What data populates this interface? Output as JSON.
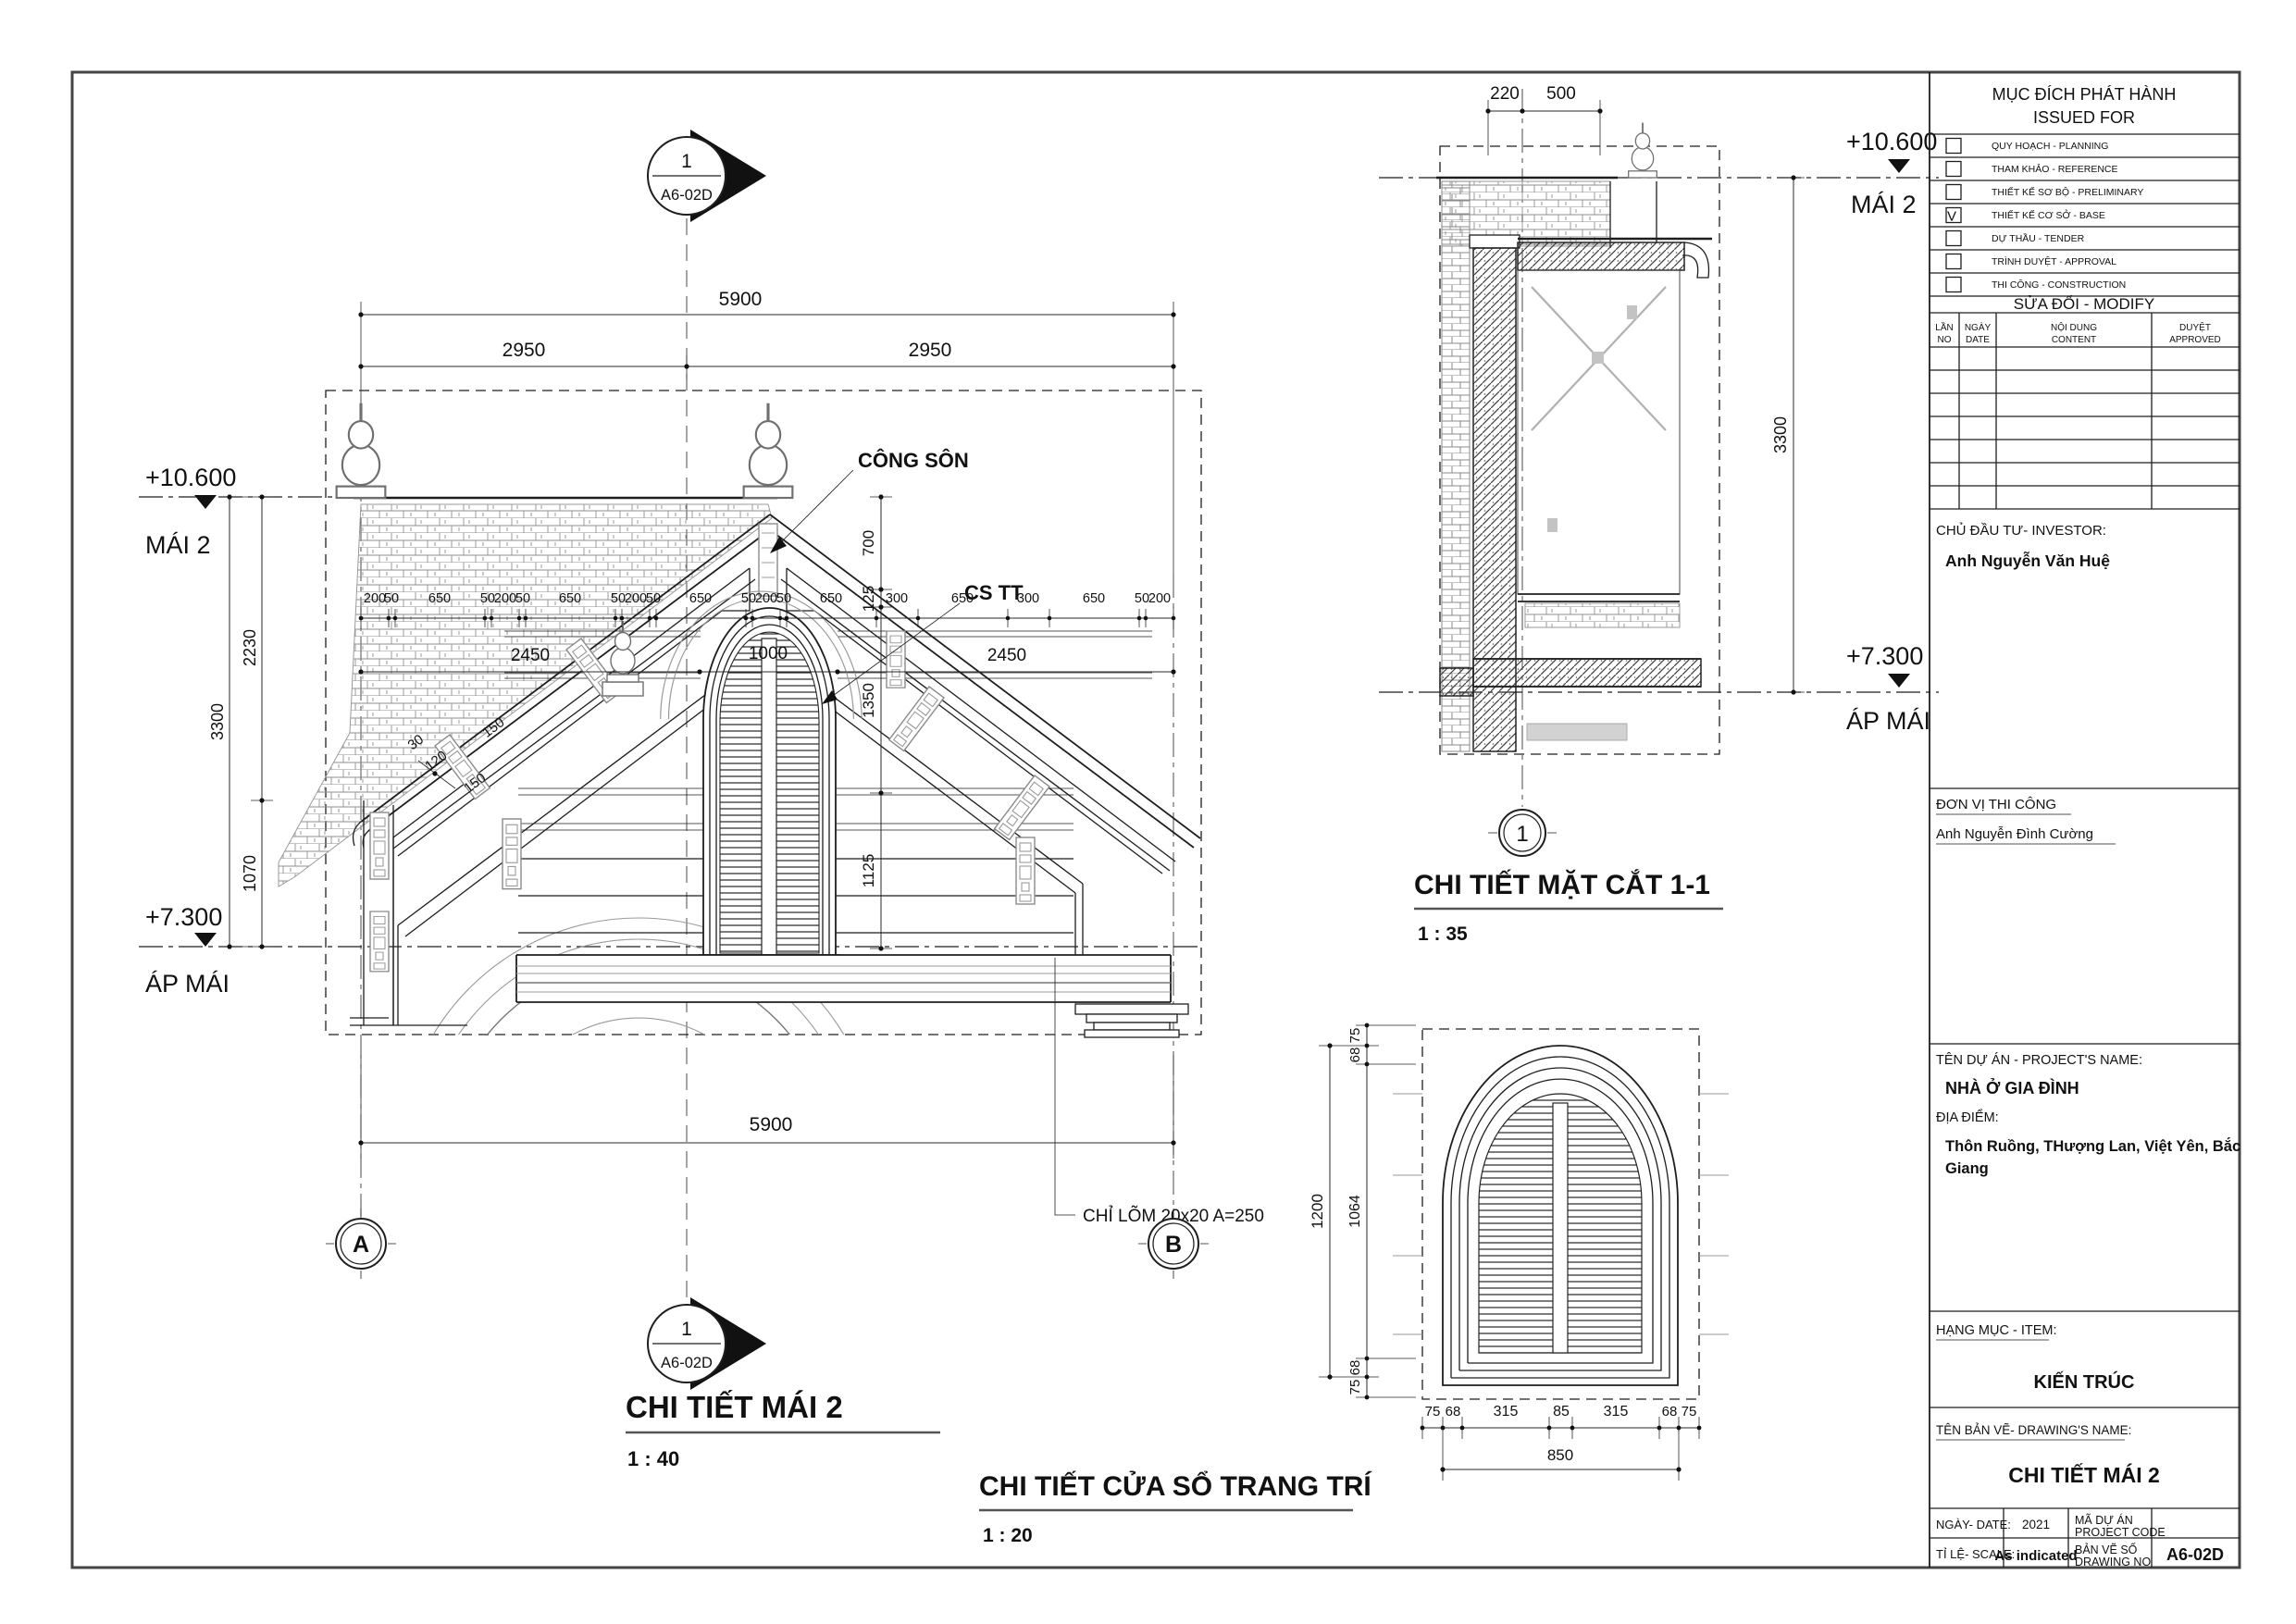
{
  "sheet": {
    "bg": "#ffffff",
    "line_color": "#1e1e1e",
    "gray_color": "#9a9a9a",
    "border_color": "#454545"
  },
  "levels": {
    "mai2": {
      "elev": "+10.600",
      "name": "MÁI 2"
    },
    "ap_mai": {
      "elev": "+7.300",
      "name": "ÁP MÁI"
    }
  },
  "callout": {
    "number": "1",
    "sheet": "A6-02D"
  },
  "views": {
    "roof": {
      "title": "CHI TIẾT MÁI 2",
      "scale": "1 : 40",
      "grids": [
        "A",
        "B"
      ],
      "annotations": {
        "cong_son": "CÔNG SÔN",
        "cs_tt": "CS TT",
        "chi_lom": "CHỈ LÕM 20x20 A=250"
      },
      "dims": {
        "top_total": "5900",
        "halves": [
          "2950",
          "2950"
        ],
        "chain": [
          "200",
          "50",
          "650",
          "50",
          "200",
          "50",
          "650",
          "50",
          "200",
          "50",
          "650",
          "50",
          "200",
          "50",
          "650",
          "300",
          "650",
          "300",
          "650",
          "50",
          "200"
        ],
        "mid": [
          "2450",
          "1000",
          "2450"
        ],
        "right_col": [
          "700",
          "125",
          "1350",
          "1125"
        ],
        "left_total": "3300",
        "left_segs": [
          "2230",
          "1070"
        ],
        "slope": [
          "150",
          "30",
          "120",
          "150"
        ],
        "bottom_total": "5900"
      }
    },
    "section": {
      "title": "CHI TIẾT MẶT CẮT 1-1",
      "scale": "1 : 35",
      "grid": "1",
      "dims": {
        "top": [
          "220",
          "500"
        ],
        "height": "3300"
      }
    },
    "window": {
      "title": "CHI TIẾT CỬA SỔ TRANG TRÍ",
      "scale": "1 : 20",
      "dims": {
        "left_total": "1200",
        "left_chain": [
          "75",
          "68",
          "1064",
          "68",
          "75"
        ],
        "bottom_chain": [
          "75",
          "68",
          "315",
          "85",
          "315",
          "68",
          "75"
        ],
        "bottom_total": "850"
      }
    }
  },
  "title_block": {
    "issued_for": {
      "title_vi": "MỤC ĐÍCH PHÁT HÀNH",
      "title_en": "ISSUED FOR",
      "check_mark": "V",
      "items": [
        {
          "label": "QUY HOẠCH - PLANNING",
          "checked": false
        },
        {
          "label": "THAM KHẢO - REFERENCE",
          "checked": false
        },
        {
          "label": "THIẾT KẾ SƠ BỘ - PRELIMINARY",
          "checked": false
        },
        {
          "label": "THIẾT KẾ CƠ SỞ - BASE",
          "checked": true
        },
        {
          "label": "DỰ THẦU - TENDER",
          "checked": false
        },
        {
          "label": "TRÌNH DUYỆT - APPROVAL",
          "checked": false
        },
        {
          "label": "THI CÔNG - CONSTRUCTION",
          "checked": false
        }
      ]
    },
    "modify": {
      "title": "SỬA ĐỔI - MODIFY",
      "columns": [
        {
          "vi": "LẦN",
          "en": "NO"
        },
        {
          "vi": "NGÀY",
          "en": "DATE"
        },
        {
          "vi": "NỘI DUNG",
          "en": "CONTENT"
        },
        {
          "vi": "DUYỆT",
          "en": "APPROVED"
        }
      ],
      "empty_rows": 7
    },
    "investor": {
      "label": "CHỦ ĐẦU TƯ- INVESTOR:",
      "name": "Anh Nguyễn Văn Huệ"
    },
    "contractor": {
      "label": "ĐƠN VỊ THI CÔNG",
      "name": "Anh Nguyễn Đình Cường"
    },
    "project": {
      "label": "TÊN DỰ ÁN - PROJECT'S NAME:",
      "name": "NHÀ Ở GIA ĐÌNH"
    },
    "location": {
      "label": "ĐỊA ĐIỂM:",
      "line1": "Thôn Ruồng, THượng Lan, Việt Yên, Bắc",
      "line2": "Giang"
    },
    "item": {
      "label": "HẠNG MỤC - ITEM:",
      "value": "KIẾN TRÚC"
    },
    "drawing_name": {
      "label": "TÊN BẢN VẼ- DRAWING'S NAME:",
      "value": "CHI TIẾT MÁI 2"
    },
    "footer": {
      "date_label": "NGÀY- DATE:",
      "date": "2021",
      "code_label_vi": "MÃ DỰ ÁN",
      "code_label_en": "PROJECT CODE",
      "code": "",
      "scale_label": "TỈ LỆ- SCALE:",
      "scale": "As indicated",
      "no_label_vi": "BẢN VẼ SỐ",
      "no_label_en": "DRAWING NO",
      "no": "A6-02D"
    }
  }
}
